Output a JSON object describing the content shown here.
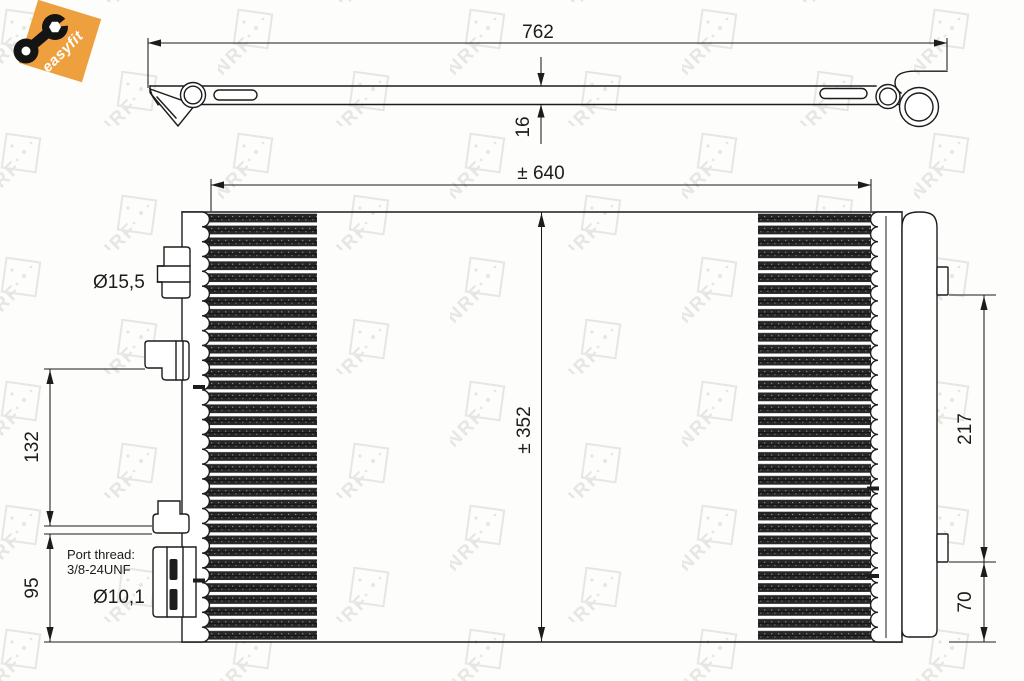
{
  "badge": {
    "label": "easyfit",
    "icon": "wrench-icon"
  },
  "watermark": {
    "text": "NRF"
  },
  "top_view": {
    "length_dim": "762",
    "thickness_dim": "16"
  },
  "front_view": {
    "core_width_dim": "± 640",
    "core_height_dim": "± 352",
    "left_upper_dim": "132",
    "left_lower_dim": "95",
    "right_upper_dim": "217",
    "right_lower_dim": "70",
    "top_port_diameter": "Ø15,5",
    "bottom_port_diameter": "Ø10,1",
    "port_thread_line1": "Port thread:",
    "port_thread_line2": "3/8-24UNF"
  },
  "colors": {
    "line": "#1c1c1c",
    "orange": "#efa03e",
    "watermark": "#e7e6e2",
    "fin": "#262626",
    "bg": "#fdfdfc"
  }
}
